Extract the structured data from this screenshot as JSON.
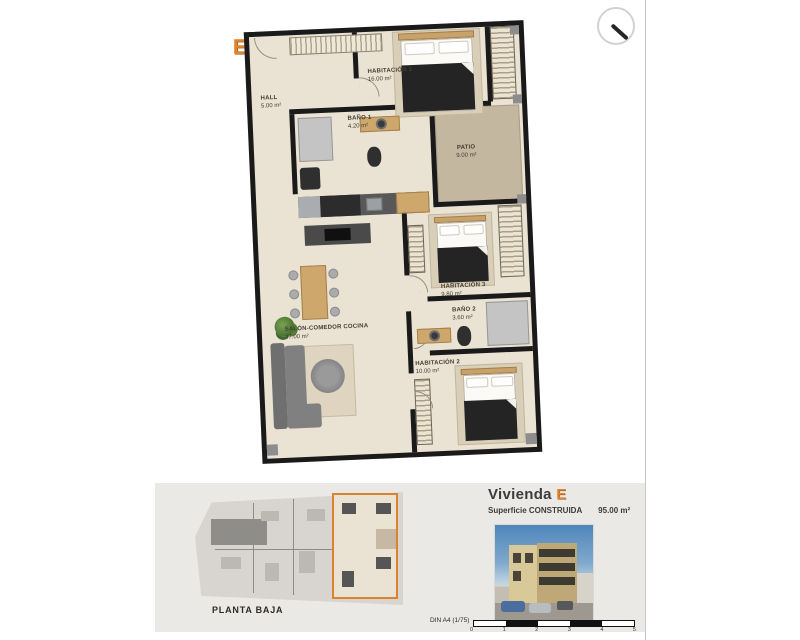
{
  "icons": {
    "top_right": "magnifier-icon"
  },
  "plan": {
    "unit_letter": "E",
    "accent_color": "#e0842e",
    "wall_color": "#1a1a1a",
    "floor_color": "#eae2d3",
    "patio_color": "#c3b7a0",
    "rooms": [
      {
        "id": "hall",
        "name": "HALL",
        "area": "5.00 m²"
      },
      {
        "id": "habitacion1",
        "name": "HABITACIÓN 1",
        "area": "16.00 m²"
      },
      {
        "id": "bano1",
        "name": "BAÑO 1",
        "area": "4.20 m²"
      },
      {
        "id": "patio",
        "name": "PATIO",
        "area": "9.00 m²"
      },
      {
        "id": "salon",
        "name": "SALÓN-COMEDOR COCINA",
        "area": "37.00 m²"
      },
      {
        "id": "habitacion3",
        "name": "HABITACIÓN 3",
        "area": "9.80 m²"
      },
      {
        "id": "bano2",
        "name": "BAÑO 2",
        "area": "3.60 m²"
      },
      {
        "id": "habitacion2",
        "name": "HABITACIÓN 2",
        "area": "10.00 m²"
      }
    ]
  },
  "footer": {
    "plan_title": "PLANTA BAJA",
    "unit_title": "Vivienda",
    "unit_letter": "E",
    "surface_label": "Superficie CONSTRUIDA",
    "surface_value": "95.00 m²",
    "sheet_label": "DIN A4 (1/75)",
    "scale_ticks": [
      "0",
      "1",
      "2",
      "3",
      "4",
      "5"
    ]
  }
}
